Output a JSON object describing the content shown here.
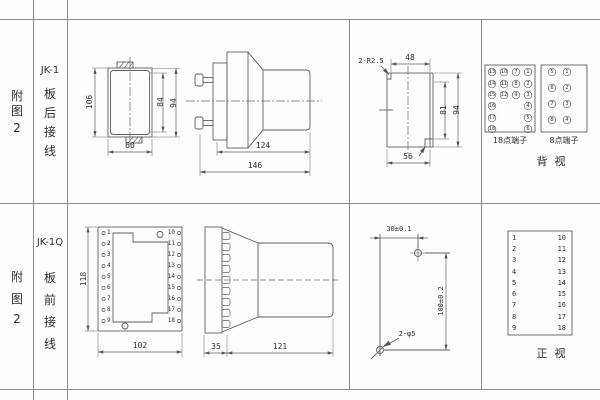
{
  "row1": {
    "fig": [
      "附",
      "图",
      "2"
    ],
    "model": "JK-1",
    "wiring": [
      "板",
      "后",
      "接",
      "线"
    ],
    "front": {
      "d106": "106",
      "d84": "84",
      "d94": "94",
      "d60": "60"
    },
    "side": {
      "d124": "124",
      "d146": "146"
    },
    "cutout": {
      "r": "2-R2.5",
      "d48": "48",
      "d81": "81",
      "d94": "94",
      "d56": "56"
    },
    "t18": {
      "label": "18点端子",
      "rows": [
        [
          "13",
          "10",
          "7",
          "1"
        ],
        [
          "14",
          "11",
          "8",
          "2"
        ],
        [
          "15",
          "12",
          "9",
          "3"
        ],
        [
          "16",
          "4"
        ],
        [
          "17",
          "5"
        ],
        [
          "18",
          "6"
        ]
      ]
    },
    "t8": {
      "label": "8点端子",
      "rows": [
        [
          "5",
          "1"
        ],
        [
          "6",
          "2"
        ],
        [
          "7",
          "3"
        ],
        [
          "8",
          "4"
        ]
      ]
    },
    "view": "背  视"
  },
  "row2": {
    "fig": [
      "附",
      "图",
      "2"
    ],
    "model": "JK-1Q",
    "wiring": [
      "板",
      "前",
      "接",
      "线"
    ],
    "front": {
      "d118": "118",
      "d102": "102",
      "left": [
        "1",
        "2",
        "3",
        "4",
        "5",
        "6",
        "7",
        "8",
        "9"
      ],
      "right": [
        "10",
        "11",
        "12",
        "13",
        "14",
        "15",
        "16",
        "17",
        "18"
      ]
    },
    "side": {
      "d35": "35",
      "d121": "121"
    },
    "drill": {
      "dh": "30±0.1",
      "dv": "100±0.2",
      "holes": "2-φ5"
    },
    "panel": {
      "left": [
        "1",
        "2",
        "3",
        "4",
        "5",
        "6",
        "7",
        "8",
        "9"
      ],
      "right": [
        "10",
        "11",
        "12",
        "13",
        "14",
        "15",
        "16",
        "17",
        "18"
      ],
      "label": "正  视"
    }
  }
}
